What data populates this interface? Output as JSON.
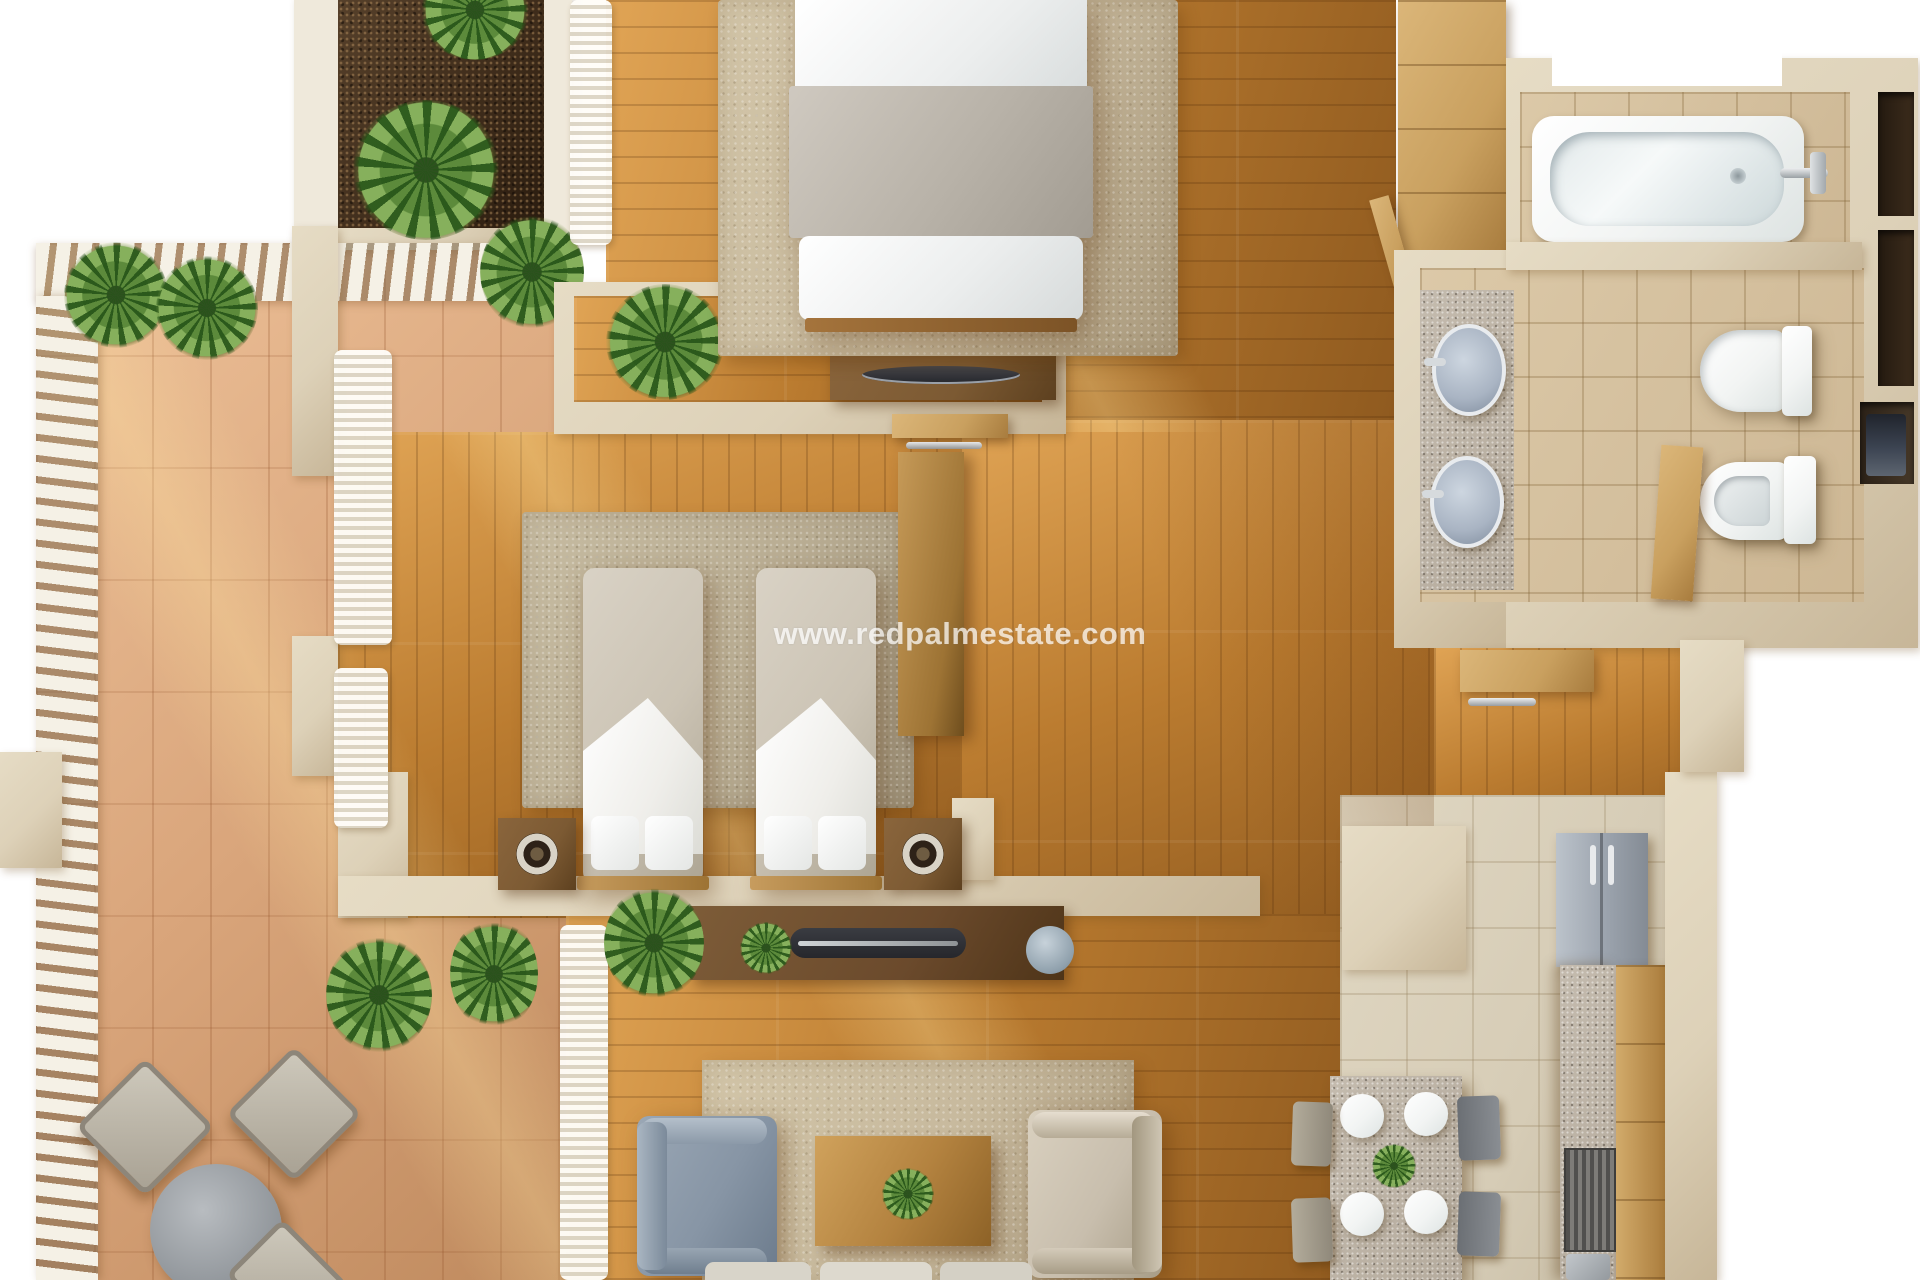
{
  "watermark": {
    "text": "www.redpalmestate.com"
  },
  "scene": {
    "type": "3d-apartment-floor-plan-render",
    "rooms": [
      "terrace",
      "planter-garden",
      "master-bedroom",
      "second-bedroom",
      "living-room",
      "kitchen-dining",
      "bathroom",
      "entry-hall"
    ],
    "objects": [
      "double-bed",
      "twin-bed",
      "twin-bed",
      "nightstand",
      "nightstand",
      "tv-console",
      "tv-console",
      "armchair",
      "armchair",
      "coffee-table",
      "sofa",
      "dining-table",
      "dining-chairs",
      "plates",
      "fridge",
      "kitchen-counter",
      "stove",
      "kitchen-sink",
      "bathtub",
      "washbasin",
      "washbasin",
      "toilet",
      "bidet",
      "wardrobe",
      "outdoor-table",
      "outdoor-chairs",
      "palm-plants",
      "pergola",
      "curtains"
    ]
  },
  "colors": {
    "bg": "#ffffff",
    "wall": "#ddd1b8",
    "wallShade": "#c7b698",
    "wallWhite": "#efe9db",
    "woodLight": "#e0a455",
    "woodMid": "#bb7c30",
    "woodDark": "#8f5a1f",
    "woodFurniture": "#7c5a33",
    "woodPale": "#c9a05f",
    "terraLight": "#eec29a",
    "terra": "#d9a57b",
    "terraDark": "#bf8a5e",
    "soil": "#3d2b1a",
    "plantDark": "#2e511f",
    "plant": "#5c8a3b",
    "plantLight": "#86b05c",
    "rugMaster": "#c7b99d",
    "rugTwin": "#b9ad93",
    "bathTile": "#cdb794",
    "bathTileLight": "#dcc9a8",
    "kitchenTile": "#d6ccb6",
    "granite": "#b5ab9d",
    "fixtureWhite": "#f2f4f3",
    "sinkBlue": "#a9b4c3",
    "chairGrey": "#8795a5",
    "chairTan": "#c8bead",
    "fridgeGrey": "#9ba3ad",
    "curtain": "#f7f5ee",
    "slat": "#f5f1e6",
    "darkUnit": "#3c4452",
    "tvDark": "#26272c",
    "bedGrey": "#b8b2a8",
    "bedWhite": "#eceeee",
    "twinBedTop": "#cbc3b4"
  }
}
